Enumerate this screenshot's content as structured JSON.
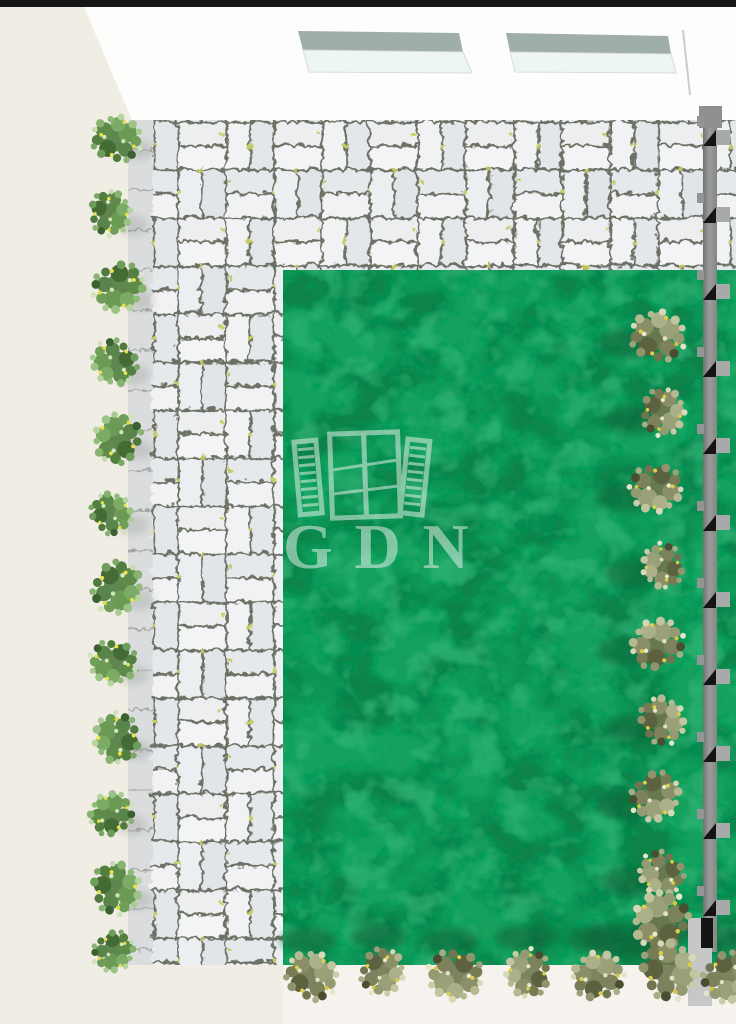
{
  "scene": {
    "description": "top-down 3d render of courtyard garden",
    "watermark": {
      "text": "GDN",
      "icon": "open-window-with-shutters-icon",
      "opacity": 0.52
    },
    "palette": {
      "top_bar": "#161616",
      "wall_beige": "#F0EDE5",
      "ceiling_white": "#FDFDFC",
      "skylight_band": "#9FADAB",
      "skylight_glass": "#EEF6F5",
      "paver": "#E9ECEE",
      "paver_joint": "#6D7165",
      "moss": "#C6CA67",
      "lawn_green": "#16A05D",
      "lawn_dark": "#0B7A45",
      "lawn_light": "#31B678",
      "fence_gray": "#8E8F8F",
      "fence_foot": "#C6C7C7",
      "bush_green": "#5E8B49",
      "bush_olive": "#8A8F68",
      "flower_yellow": "#E6DF3D",
      "bottom_strip": "#F6F3EE",
      "watermark_tint": "#EDF3EE"
    },
    "planting": {
      "left_row_count": 12,
      "right_row_count": 9,
      "bottom_row_count": 7
    },
    "fence": {
      "stub_count": 11
    }
  }
}
